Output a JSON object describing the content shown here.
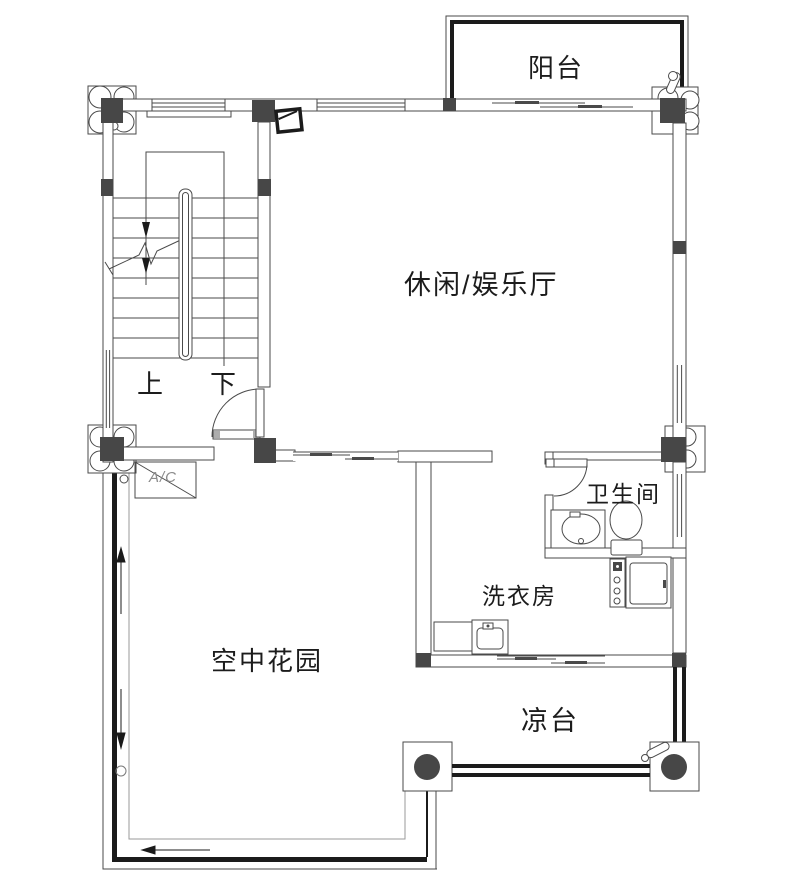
{
  "title": "二层平面图",
  "rooms": {
    "balcony": {
      "label": "阳台"
    },
    "hall": {
      "label": "休闲/娱乐厅"
    },
    "bathroom": {
      "label": "卫生间"
    },
    "laundry": {
      "label": "洗衣房"
    },
    "garden": {
      "label": "空中花园"
    },
    "terrace": {
      "label": "凉台"
    }
  },
  "stairs": {
    "up_label": "上",
    "down_label": "下"
  },
  "equipment": {
    "ac_label": "A/C"
  },
  "colors": {
    "line": "#4a4a4a",
    "column_fill": "#474747",
    "heavy_outline": "#1b1b1b",
    "inner_path": "#9a9a9a",
    "background": "#ffffff"
  }
}
